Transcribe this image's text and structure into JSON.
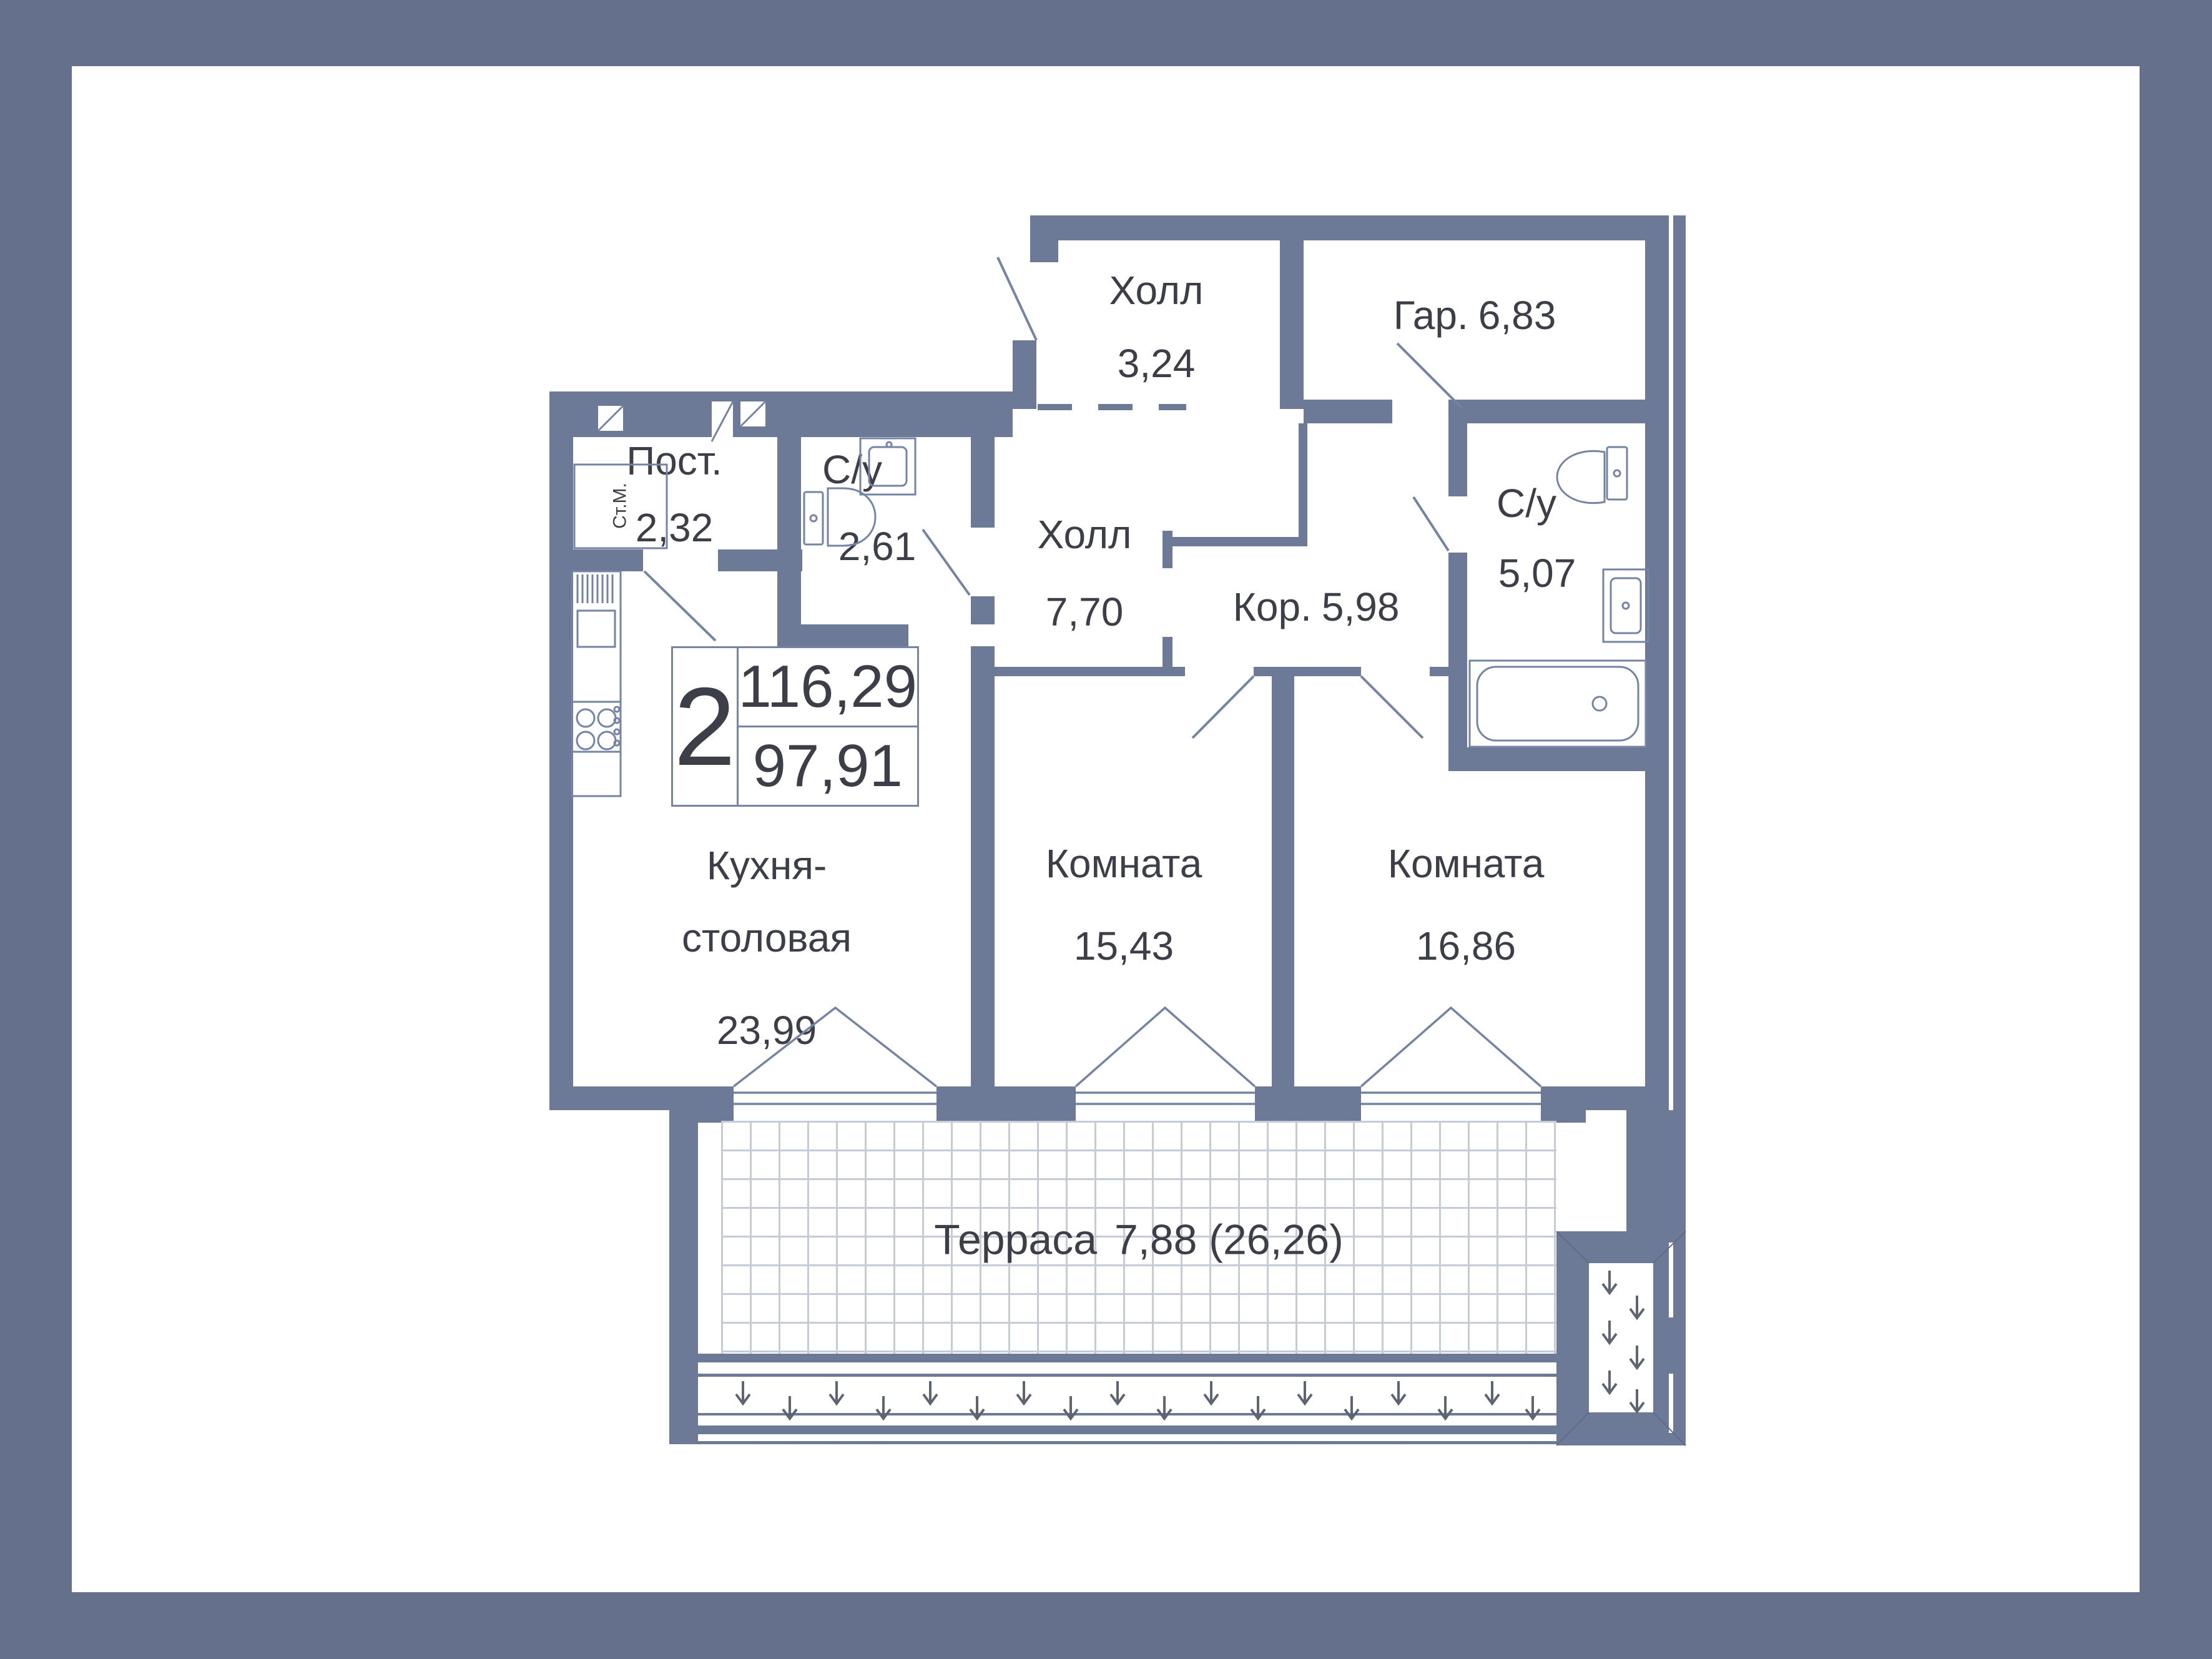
{
  "badge": {
    "rooms": "2",
    "area_total": "116,29",
    "area_living": "97,91"
  },
  "rooms": {
    "hall_entry": {
      "name": "Холл",
      "area": "3,24"
    },
    "wardrobe": {
      "name": "Гар.",
      "area": "6,83"
    },
    "laundry": {
      "name": "Пост.",
      "area": "2,32"
    },
    "wc_small": {
      "name": "С/у",
      "area": "2,61"
    },
    "hall": {
      "name": "Холл",
      "area": "7,70"
    },
    "corridor": {
      "name": "Кор.",
      "area": "5,98"
    },
    "wc_big": {
      "name": "С/у",
      "area": "5,07"
    },
    "kitchen": {
      "name_line1": "Кухня-",
      "name_line2": "столовая",
      "area": "23,99"
    },
    "room_a": {
      "name": "Комната",
      "area": "15,43"
    },
    "room_b": {
      "name": "Комната",
      "area": "16,86"
    },
    "terrace": {
      "name": "Терраса",
      "area": "7,88 (26,26)"
    }
  },
  "fixtures": {
    "washing_machine": "Ст.М."
  },
  "colors": {
    "frame": "#65718c",
    "wall": "#6c7a98",
    "paper": "#ffffff",
    "line": "#7384a6",
    "text": "#3c3f47",
    "tile_line": "#c5cbd9",
    "arrow": "#5d6472"
  }
}
